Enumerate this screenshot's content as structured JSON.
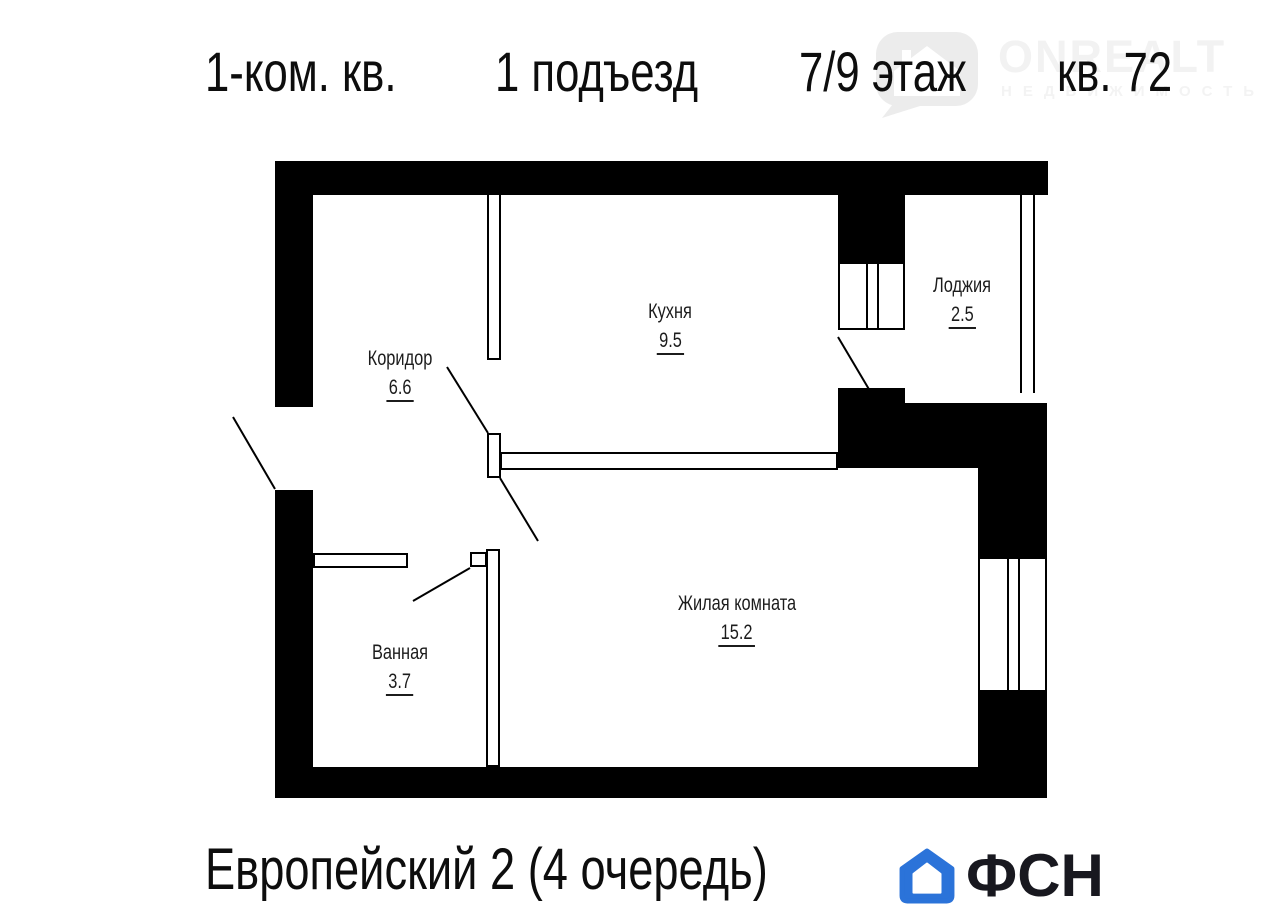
{
  "title": {
    "parts": [
      "1-ком. кв.",
      "1 подъезд",
      "7/9 этаж",
      "кв. 72"
    ]
  },
  "watermark": {
    "brand": "ONREALT",
    "subtitle": "НЕДВИЖИМОСТЬ",
    "color": "#f2f2f2"
  },
  "plan": {
    "rooms": [
      {
        "name": "Кухня",
        "area": "9.5"
      },
      {
        "name": "Лоджия",
        "area": "2.5"
      },
      {
        "name": "Коридор",
        "area": "6.6"
      },
      {
        "name": "Жилая комната",
        "area": "15.2"
      },
      {
        "name": "Ванная",
        "area": "3.7"
      }
    ],
    "wall_color": "#000000"
  },
  "footer": {
    "project": "Европейский 2 (4 очередь)",
    "brand": "ФСН",
    "brand_color": "#2b73d9"
  }
}
